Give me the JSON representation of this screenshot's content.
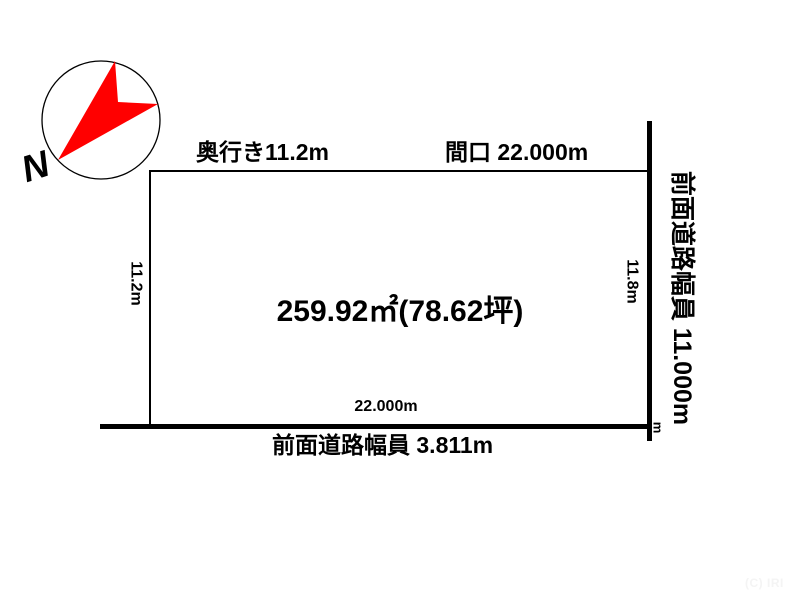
{
  "compass": {
    "letter": "N"
  },
  "plot": {
    "depth_top_label": "奥行き11.2m",
    "frontage_top_label": "間口 22.000m",
    "area_label": "259.92㎡(78.62坪)",
    "left_depth_label": "11.2m",
    "right_depth_label": "11.8m",
    "bottom_frontage_label": "22.000m"
  },
  "roads": {
    "bottom_road_label": "前面道路幅員 3.811m",
    "right_road_label": "前面道路幅員 11.000m",
    "corner_unit_label": "m"
  },
  "footer": {
    "copyright": "(C) IRI"
  },
  "colors": {
    "line": "#000000",
    "compass_arrow": "#ff0000",
    "background": "#ffffff",
    "copyright_text": "#f4f4f4"
  }
}
